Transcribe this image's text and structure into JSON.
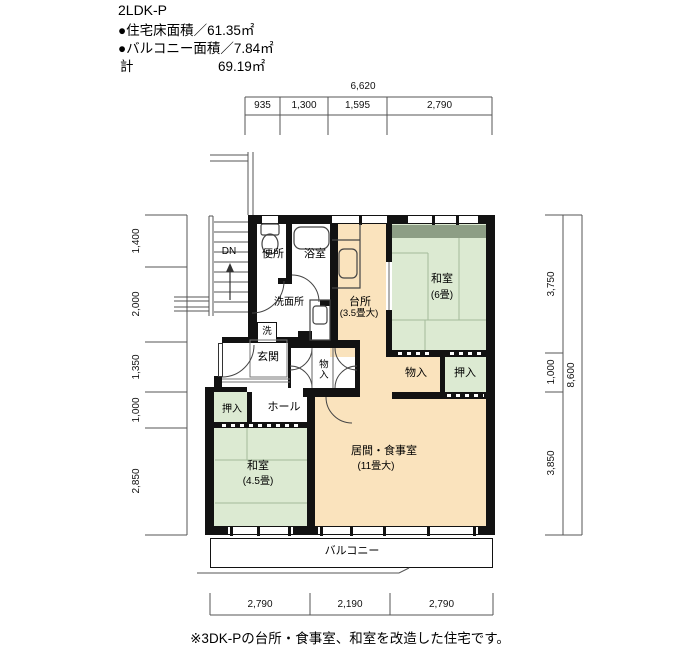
{
  "header": {
    "plan_type": "2LDK-P",
    "floor_area": "●住宅床面積／61.35㎡",
    "balcony_area": "●バルコニー面積／7.84㎡",
    "total_label": "計",
    "total_value": "69.19㎡"
  },
  "footer": {
    "note": "※3DK-Pの台所・食事室、和室を改造した住宅です。"
  },
  "rooms": {
    "toilet": "便所",
    "bath": "浴室",
    "washroom": "洗面所",
    "washer": "洗",
    "entrance": "玄関",
    "hall": "ホール",
    "storage_entrance": "物入",
    "storage_right": "物入",
    "closet_hall": "押入",
    "closet_right": "押入",
    "kitchen": "台所",
    "kitchen_size": "(3.5畳大)",
    "washitsu6": "和室",
    "washitsu6_size": "(6畳)",
    "washitsu45": "和室",
    "washitsu45_size": "(4.5畳)",
    "living": "居間・食事室",
    "living_size": "(11畳大)",
    "balcony": "バルコニー",
    "stairs_down": "DN"
  },
  "dimensions": {
    "top_total": "6,620",
    "top": [
      "935",
      "1,300",
      "1,595",
      "2,790"
    ],
    "left": [
      "1,400",
      "2,000",
      "1,350",
      "1,000",
      "2,850"
    ],
    "right": [
      "3,750",
      "1,000",
      "3,850"
    ],
    "right_total": "8,600",
    "bottom": [
      "2,790",
      "2,190",
      "2,790"
    ]
  },
  "colors": {
    "tatami_green": "#dcead2",
    "wood_beige": "#fae3bd",
    "window_band_green": "#8d9e85",
    "wall_black": "#121212"
  }
}
